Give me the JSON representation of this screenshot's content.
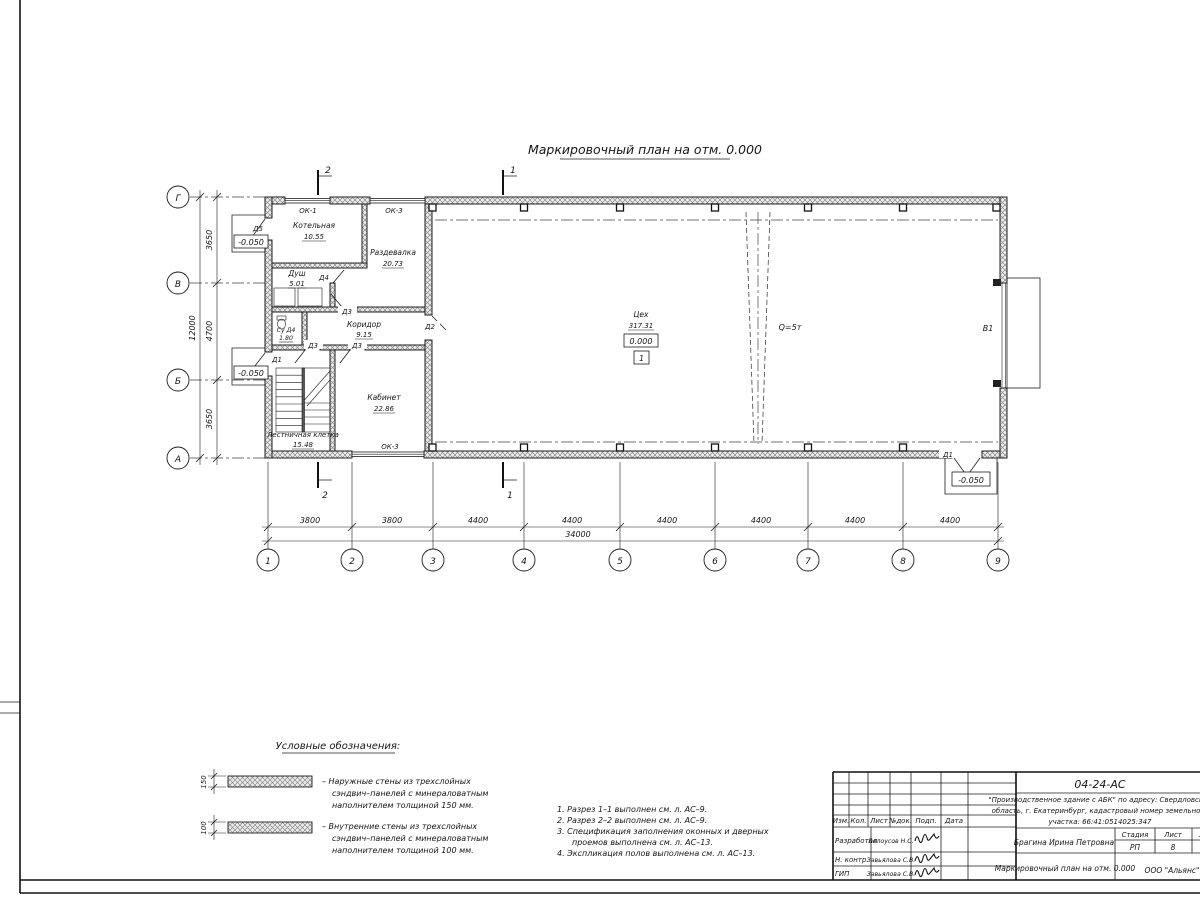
{
  "drawing": {
    "title": "Маркировочный план на отм. 0.000"
  },
  "axes": {
    "cols": [
      "1",
      "2",
      "3",
      "4",
      "5",
      "6",
      "7",
      "8",
      "9"
    ],
    "rows": [
      "Г",
      "В",
      "Б",
      "А"
    ]
  },
  "dims": {
    "bottom": [
      "3800",
      "3800",
      "4400",
      "4400",
      "4400",
      "4400",
      "4400",
      "4400"
    ],
    "total_bottom": "34000",
    "left": [
      "3650",
      "4700",
      "3650"
    ],
    "total_left": "12000"
  },
  "plan": {
    "rooms": [
      {
        "name": "Котельная",
        "area": "10.55"
      },
      {
        "name": "Раздевалка",
        "area": "20.73"
      },
      {
        "name": "Душ",
        "area": "5.01"
      },
      {
        "name": "Су Д4",
        "area": "1.80"
      },
      {
        "name": "Коридор",
        "area": "9.15"
      },
      {
        "name": "Кабинет",
        "area": "22.86"
      },
      {
        "name": "Лестничная клетка",
        "area": "15.48"
      },
      {
        "name": "Цех",
        "area": "317.31"
      }
    ],
    "door_labels": {
      "d5": "Д5",
      "d4": "Д4",
      "d3": "Д3",
      "d2": "Д2",
      "d1": "Д1",
      "v1": "В1"
    },
    "window_labels": {
      "ok1": "ОК-1",
      "ok3": "ОК-3"
    },
    "levels": {
      "zero": "0.000",
      "minus": "-0.050",
      "floor": "1"
    },
    "crane": "Q=5т",
    "sections": {
      "one": "1",
      "two": "2"
    }
  },
  "legend": {
    "title": "Условные обозначения:",
    "items": [
      {
        "thickness": "150",
        "lines": [
          "–  Наружные стены из трехслойных",
          "сэндвич–панелей с минераловатным",
          "наполнителем толщиной 150 мм."
        ]
      },
      {
        "thickness": "100",
        "lines": [
          "–  Внутренние стены из трехслойных",
          "сэндвич–панелей с минераловатным",
          "наполнителем толщиной 100 мм."
        ]
      }
    ]
  },
  "notes": {
    "lines": [
      "1. Разрез 1–1 выполнен см. л. АС–9.",
      "2. Разрез 2–2 выполнен см. л. АС–9.",
      "3. Спецификация заполнения оконных и дверных",
      "проемов выполнена см. л. АС–13.",
      "4. Экспликация полов выполнена см. л. АС–13."
    ]
  },
  "titleblock": {
    "doc_no": "04-24-АС",
    "project": [
      "\"Производственное здание с АБК\" по адресу: Свердловская",
      "область, г. Екатеринбург, кадастровый номер земельного",
      "участка: 66:41:0514025:347"
    ],
    "cols": [
      "Изм.",
      "Кол.",
      "Лист",
      "№док.",
      "Подп.",
      "Дата"
    ],
    "rows": [
      {
        "role": "Разработал",
        "name": "Белоусов Н.С."
      },
      {
        "role": "Н. контр.",
        "name": "Завьялова С.В."
      },
      {
        "role": "ГИП",
        "name": "Завьялова С.В."
      }
    ],
    "author": "Брагина Ирина Петровна",
    "stage_label": "Стадия",
    "stage": "РП",
    "sheet_label": "Лист",
    "sheet": "8",
    "sheets_label": "Листов",
    "sheets": "13",
    "doc_title": "Маркировочный план на отм. 0.000",
    "company": "ООО \"Альянс\""
  }
}
